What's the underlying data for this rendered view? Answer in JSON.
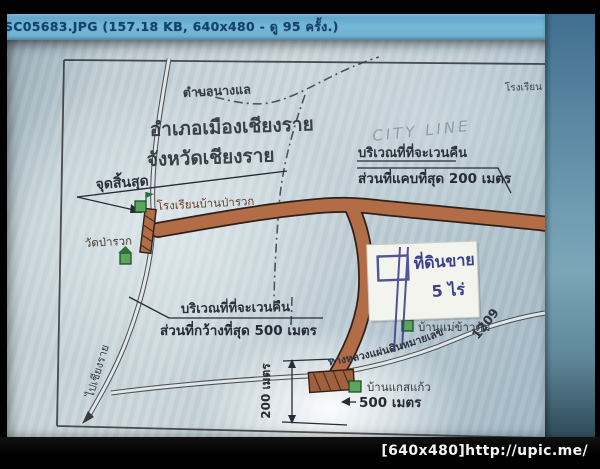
{
  "viewer": {
    "title_bar_text": "SC05683.JPG (157.18 KB, 640x480 - ดู 95 ครั้ง.)",
    "watermark_text": "[640x480]http://upic.me/"
  },
  "map": {
    "region": {
      "subdistrict": "ตำบลนางแล",
      "district": "อำเภอเมืองเชียงราย",
      "province": "จังหวัดเชียงราย"
    },
    "labels": {
      "end_point": "จุดสิ้นสุด",
      "school": "โรงเรียนบ้านป่ารวก",
      "school_partial": "โรงเรียน",
      "temple": "วัดป่ารวก",
      "village_mae_khao_tom": "บ้านแม่ข้าวต้ม",
      "village_kaew": "บ้านแกสแก้ว",
      "to_chiang_rai": "ไปเชียงราย",
      "highway_name": "ทางหลวงแผ่นดินหมายเลข",
      "highway_number": "1209",
      "city_line": "CITY LINE"
    },
    "callouts": {
      "expropriation_top": {
        "line1": "บริเวณที่ที่จะเวนคืน",
        "line2": "ส่วนที่แคบที่สุด 200 เมตร"
      },
      "expropriation_mid": {
        "line1": "บริเวณที่ที่จะเวนคืน",
        "line2": "ส่วนที่กว้างที่สุด 500 เมตร"
      }
    },
    "note": {
      "line1": "ที่ดินขาย",
      "line2": "5 ไร่"
    },
    "dimensions": {
      "width_500": "500 เมตร",
      "depth_200": "200 เมตร"
    },
    "colors": {
      "road_fill": "#b26c46",
      "road_outline": "#2e211a",
      "note_ink": "#3b3f8e",
      "icon_green": "#5aa65a",
      "titlebar_blue": "#6fb0cf"
    }
  }
}
